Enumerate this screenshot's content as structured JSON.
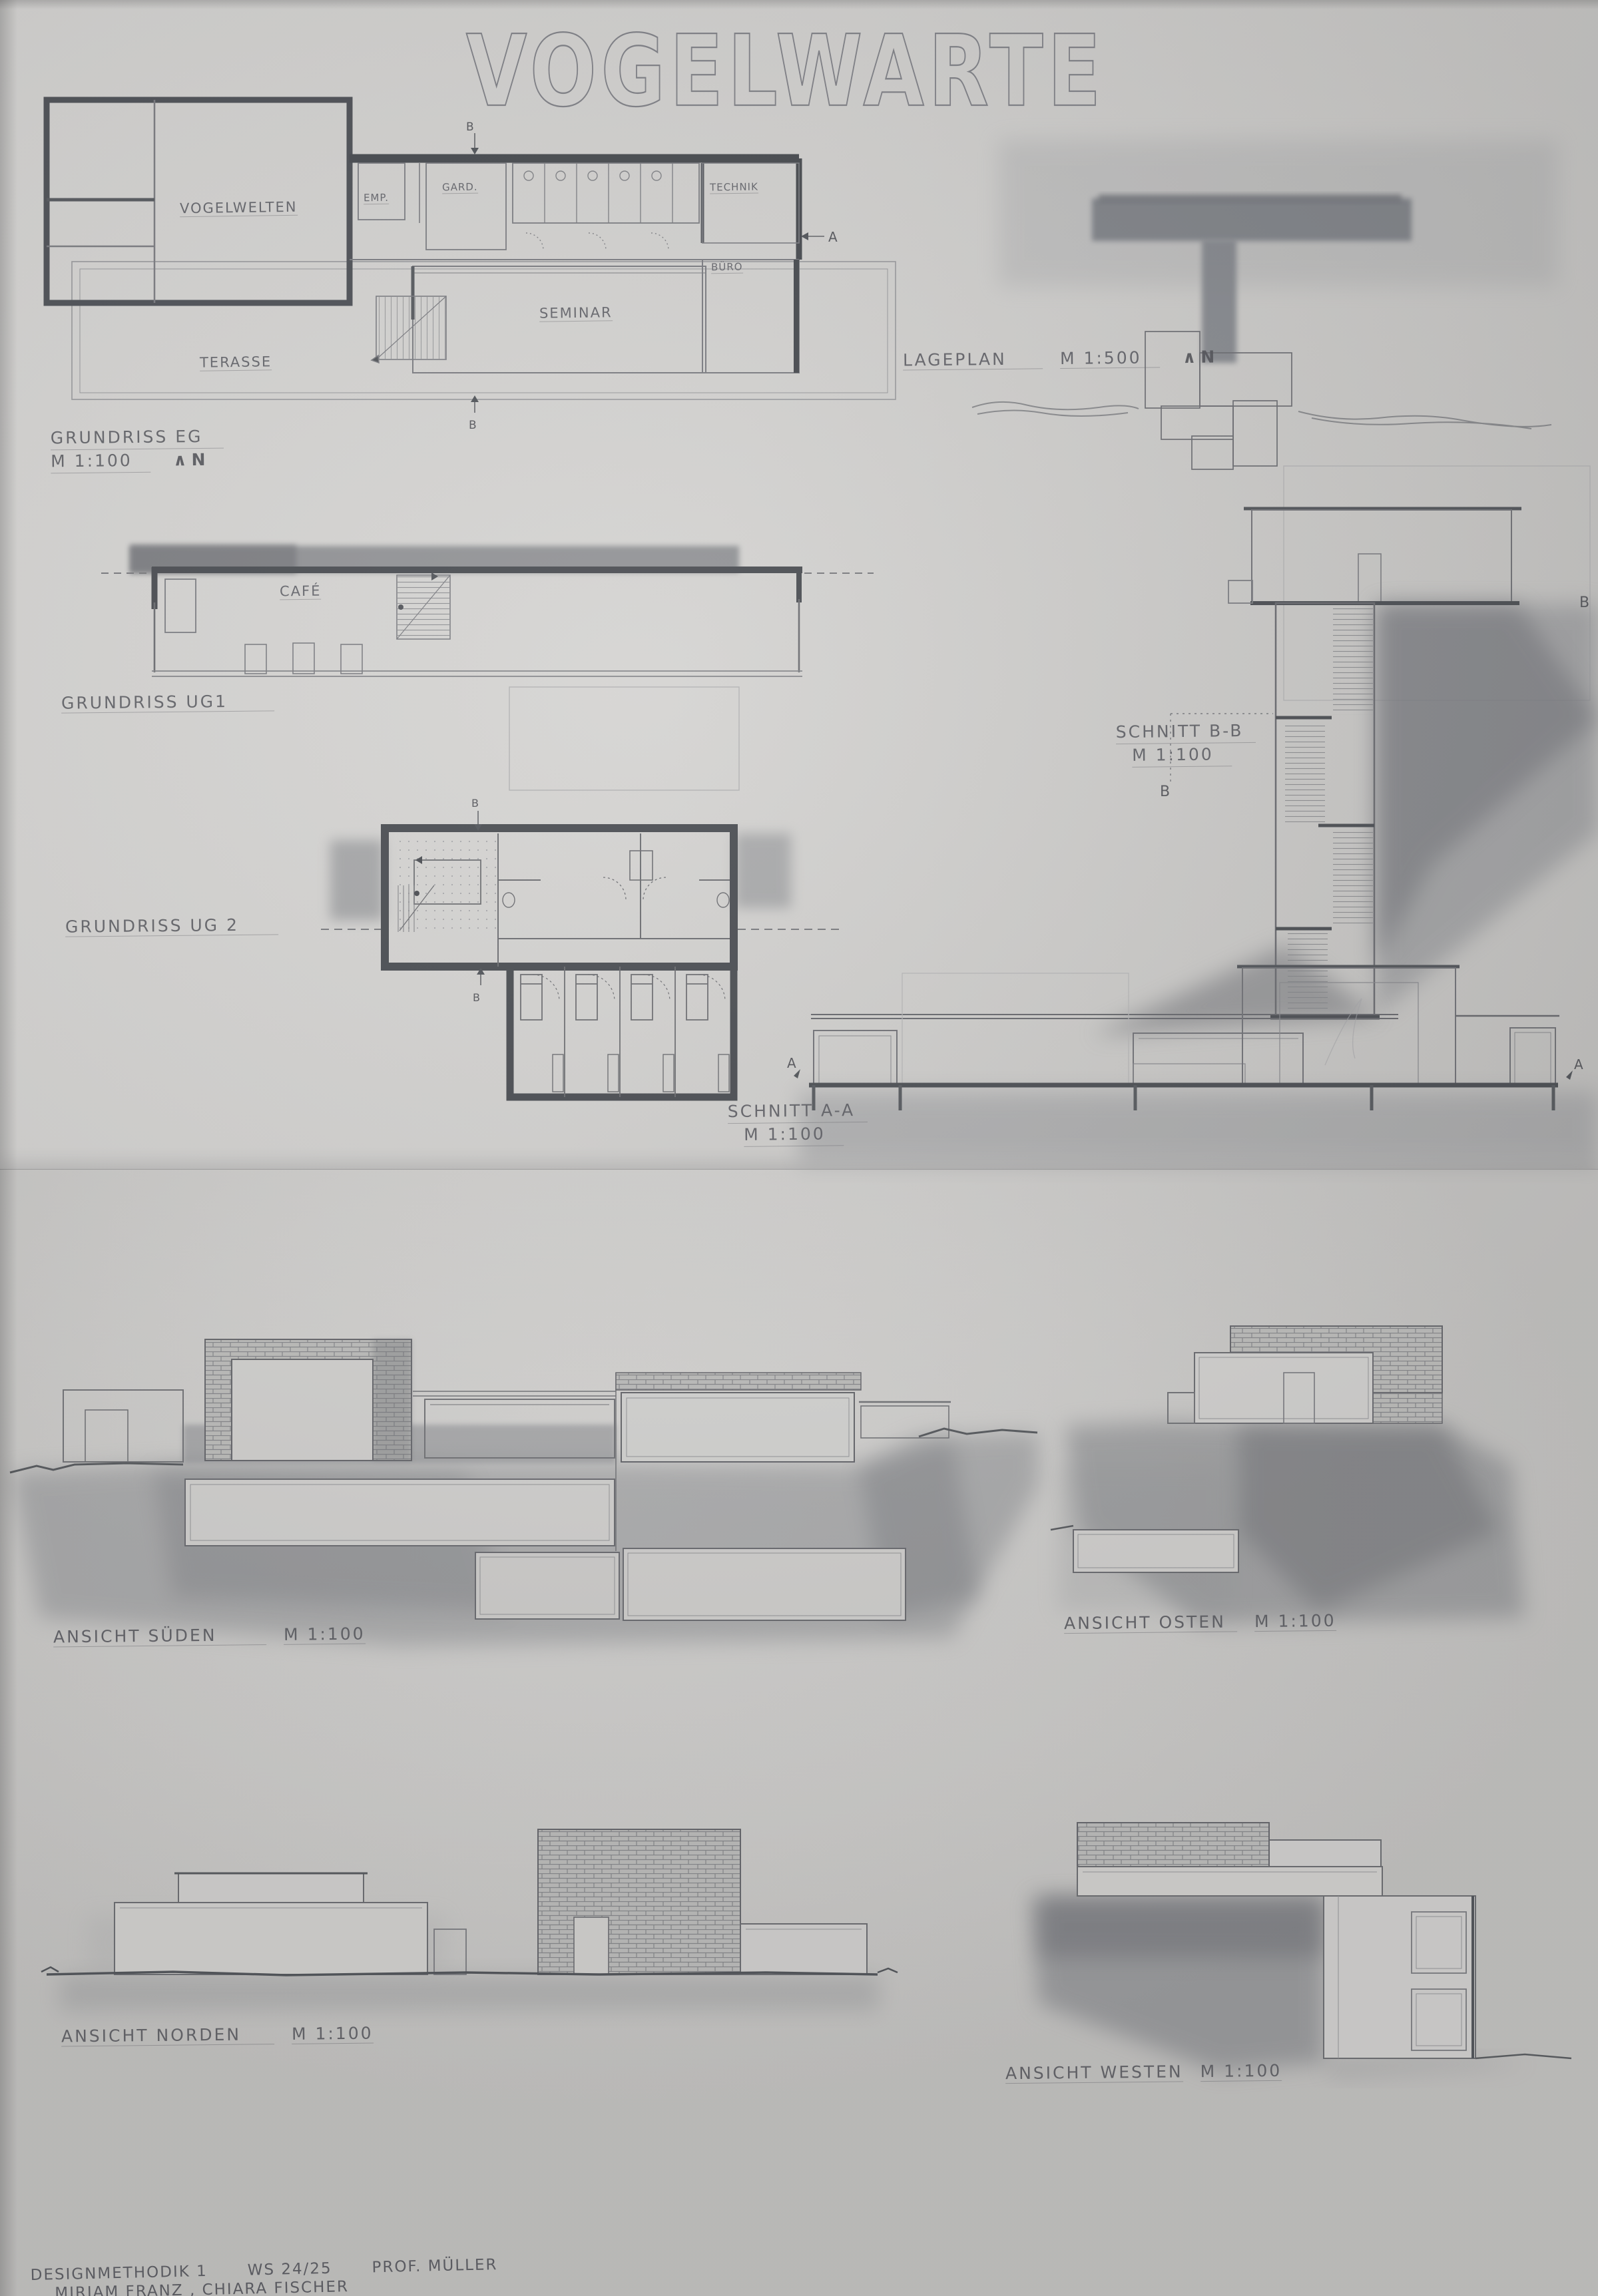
{
  "title": "VOGELWARTE",
  "colors": {
    "paper": "#d5d4d2",
    "pencil": "#6f7076",
    "wall": "#4c4f54",
    "shade": "#8d8f93"
  },
  "siteplan": {
    "name": "LAGEPLAN",
    "scale": "M 1:500",
    "north_icon": "∧",
    "north_label": "N"
  },
  "plans": {
    "eg": {
      "name": "GRUNDRISS EG",
      "scale": "M 1:100",
      "north_icon": "∧",
      "north_label": "N",
      "marker_a": "A",
      "marker_b": "B",
      "rooms": {
        "vogelwelten": "VOGELWELTEN",
        "emp": "EMP.",
        "gard": "GARD.",
        "technik": "TECHNIK",
        "buero": "BÜRO",
        "seminar": "SEMINAR",
        "terasse": "TERASSE"
      }
    },
    "ug1": {
      "name": "GRUNDRISS UG1",
      "rooms": {
        "cafe": "CAFÉ"
      }
    },
    "ug2": {
      "name": "GRUNDRISS UG 2",
      "marker_b": "B"
    }
  },
  "sections": {
    "bb": {
      "name": "SCHNITT B-B",
      "scale": "M 1:100",
      "marker": "B"
    },
    "aa": {
      "name": "SCHNITT A-A",
      "scale": "M 1:100",
      "marker": "A"
    }
  },
  "elevations": {
    "sueden": {
      "name": "ANSICHT SÜDEN",
      "scale": "M 1:100"
    },
    "osten": {
      "name": "ANSICHT OSTEN",
      "scale": "M 1:100"
    },
    "norden": {
      "name": "ANSICHT NORDEN",
      "scale": "M 1:100"
    },
    "westen": {
      "name": "ANSICHT WESTEN",
      "scale": "M 1:100"
    }
  },
  "credits": {
    "course": "DESIGNMETHODIK 1",
    "semester": "WS 24/25",
    "professor": "PROF. MÜLLER",
    "students": "MIRIAM FRANZ ,  CHIARA FISCHER"
  }
}
